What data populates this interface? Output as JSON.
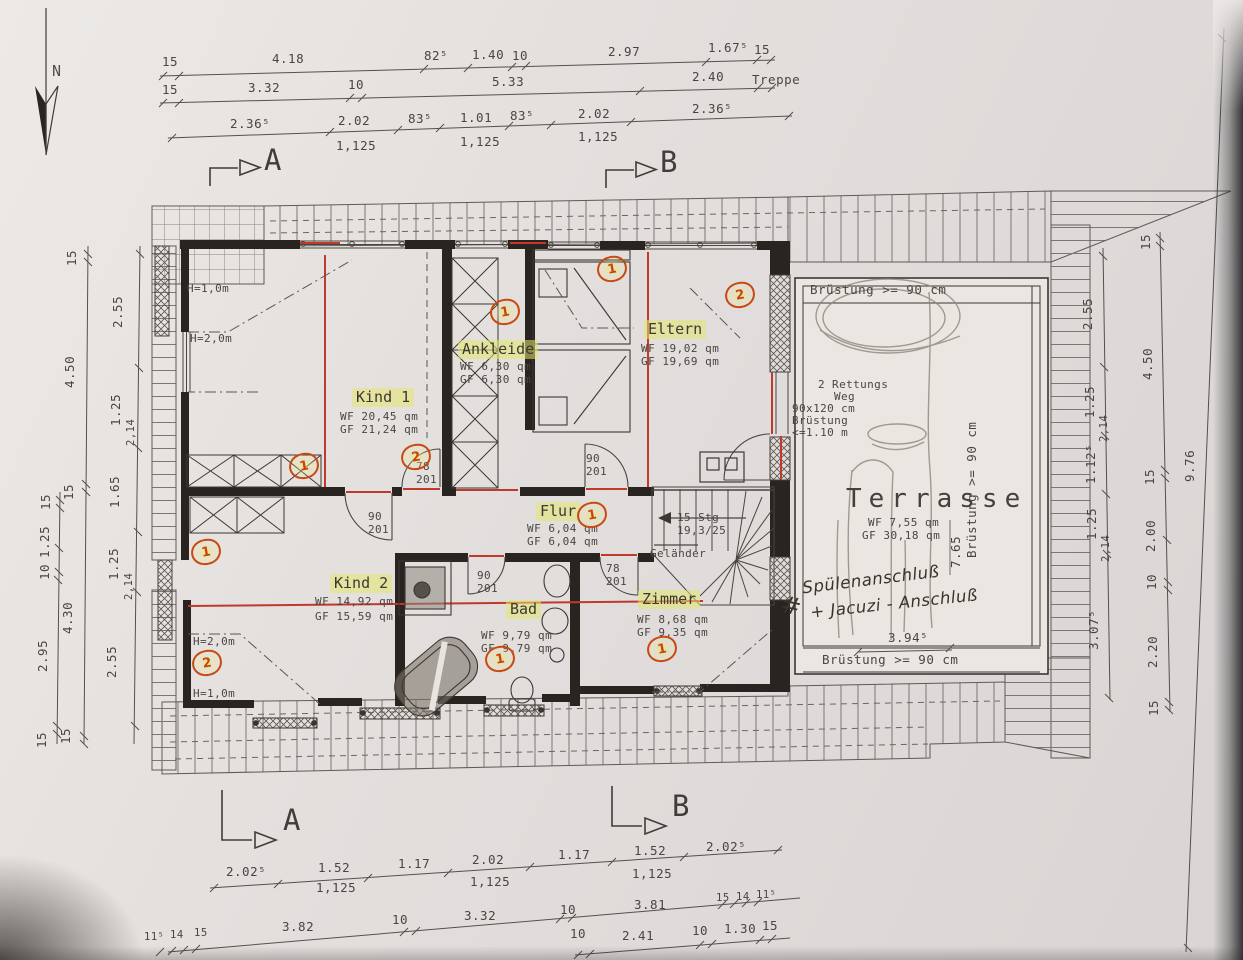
{
  "compass": {
    "label": "N"
  },
  "sections": {
    "a": "A",
    "b": "B"
  },
  "dims": {
    "top1": [
      "15",
      "4.18",
      "82⁵",
      "1.40",
      "10",
      "2.97",
      "1.67⁵",
      "15"
    ],
    "top2": [
      "15",
      "3.32",
      "10",
      "5.33",
      "2.40"
    ],
    "top2_note": "Treppe",
    "top3": [
      "2.36⁵",
      "2.02",
      "83⁵",
      "1.01",
      "83⁵",
      "2.02",
      "2.36⁵"
    ],
    "sub": "1,125",
    "tie": "2,14",
    "bottom1": [
      "2.02⁵",
      "1.52",
      "1.17",
      "2.02",
      "1.17",
      "1.52",
      "2.02⁵"
    ],
    "bottom2": [
      "11⁵",
      "14",
      "15",
      "3.82",
      "10",
      "3.32",
      "10",
      "3.81",
      "15",
      "14",
      "11⁵"
    ],
    "bottom3": [
      "10",
      "2.41",
      "10",
      "1.30",
      "15"
    ],
    "left_outer": [
      "15",
      "1.25",
      "10",
      "2.95",
      "15"
    ],
    "left_middle": [
      "15",
      "4.50",
      "15",
      "4.30",
      "15"
    ],
    "left_inner": [
      "2.55",
      "1.25",
      "1.65",
      "1.25",
      "2.55"
    ],
    "right_inner": [
      "2.55",
      "1.25",
      "1.12⁵",
      "1.25",
      "3.07⁵"
    ],
    "right_middle": [
      "15",
      "4.50",
      "15",
      "2.00",
      "10",
      "2.20",
      "15"
    ],
    "right_outer": "9.76",
    "terrace_depth": "7.65",
    "terrace_width": "3.94⁵"
  },
  "rooms": {
    "kind1": {
      "name": "Kind 1",
      "wf": "WF 20,45 qm",
      "gf": "GF 21,24 qm"
    },
    "ankleide": {
      "name": "Ankleide",
      "wf": "WF 6,30 qm",
      "gf": "GF 6,30 qm"
    },
    "eltern": {
      "name": "Eltern",
      "wf": "WF 19,02 qm",
      "gf": "GF 19,69 qm"
    },
    "kind2": {
      "name": "Kind 2",
      "wf": "WF 14,92 qm",
      "gf": "GF 15,59 qm"
    },
    "flur": {
      "name": "Flur",
      "wf": "WF 6,04 qm",
      "gf": "GF 6,04 qm"
    },
    "bad": {
      "name": "Bad",
      "wf": "WF 9,79 qm",
      "gf": "GF 9,79 qm"
    },
    "zimmer": {
      "name": "Zimmer",
      "wf": "WF 8,68 qm",
      "gf": "GF 9,35 qm"
    },
    "terrasse": {
      "name": "Terrasse",
      "wf": "WF 7,55 qm",
      "gf": "GF 30,18 qm"
    }
  },
  "stairs": {
    "steps": "15 Stg",
    "ratio": "19,3/25",
    "railing": "Geländer"
  },
  "doors": {
    "w78": "78",
    "w90": "90",
    "h201": "201"
  },
  "heights": {
    "h10": "H=1,0m",
    "h20": "H=2,0m"
  },
  "terrace": {
    "parapet": "Brüstung >= 90 cm"
  },
  "rescue": {
    "l1": "2  Rettungs",
    "l2": "Weg",
    "l3": "90x120 cm",
    "l4": "Brüstung",
    "l5": "<=1.10 m"
  },
  "handwriting": {
    "mark": "#",
    "l1": "Spülenanschluß",
    "l2": "+ Jacuzi - Anschluß"
  },
  "markers": {
    "m1": "1",
    "m2": "2"
  },
  "colors": {
    "red": "#c0392b",
    "highlight": "#e4e66e",
    "marker": "#c8430e",
    "ink": "#3a3530"
  }
}
